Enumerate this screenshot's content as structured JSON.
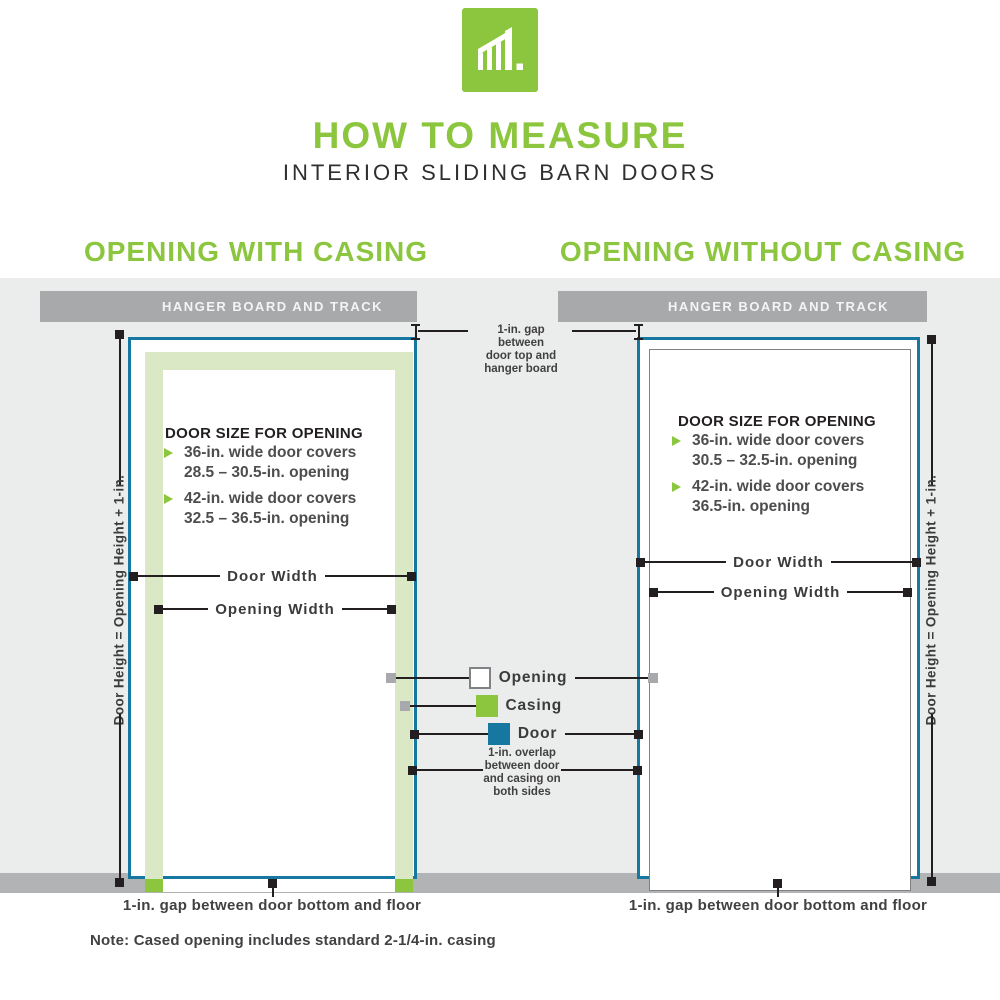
{
  "header": {
    "title": "HOW TO MEASURE",
    "subtitle": "INTERIOR SLIDING BARN DOORS"
  },
  "left_panel": {
    "heading": "OPENING WITH CASING",
    "hanger_label": "HANGER BOARD AND TRACK",
    "door_size_heading": "DOOR SIZE FOR OPENING",
    "bullets": [
      {
        "line1": "36-in. wide door covers",
        "line2": "28.5 – 30.5-in. opening"
      },
      {
        "line1": "42-in. wide door covers",
        "line2": "32.5 – 36.5-in. opening"
      }
    ],
    "door_width_label": "Door Width",
    "opening_width_label": "Opening Width",
    "height_label": "Door Height = Opening Height + 1-in.",
    "bottom_gap_label": "1-in. gap between door bottom and floor"
  },
  "right_panel": {
    "heading": "OPENING WITHOUT CASING",
    "hanger_label": "HANGER BOARD AND TRACK",
    "door_size_heading": "DOOR SIZE FOR OPENING",
    "bullets": [
      {
        "line1": "36-in. wide door covers",
        "line2": "30.5 – 32.5-in. opening"
      },
      {
        "line1": "42-in. wide door covers",
        "line2": "36.5-in. opening"
      }
    ],
    "door_width_label": "Door Width",
    "opening_width_label": "Opening Width",
    "height_label": "Door Height = Opening Height + 1-in.",
    "bottom_gap_label": "1-in. gap between door bottom and floor"
  },
  "annotations": {
    "top_gap_line1": "1-in. gap",
    "top_gap_line2": "between",
    "top_gap_line3": "door top and",
    "top_gap_line4": "hanger board",
    "overlap_line1": "1-in. overlap",
    "overlap_line2": "between door",
    "overlap_line3": "and casing on",
    "overlap_line4": "both sides"
  },
  "legend": {
    "opening_label": "Opening",
    "casing_label": "Casing",
    "door_label": "Door"
  },
  "note": "Note: Cased opening includes standard 2-1/4-in. casing",
  "colors": {
    "green": "#8CC63F",
    "pale_casing": "#DBE8C5",
    "door_teal": "#1677A0",
    "wall_gray": "#EBECEC",
    "floor_gray": "#B1B3B4",
    "hanger_board_gray": "#A7A9AB"
  }
}
